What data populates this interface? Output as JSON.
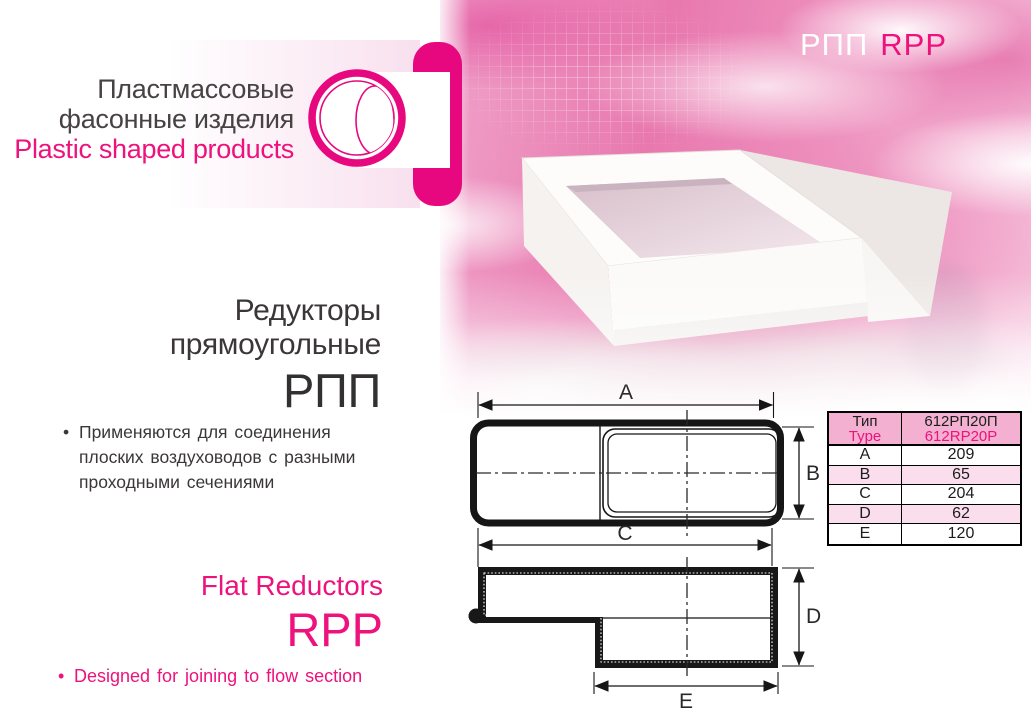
{
  "brand": {
    "title_ru_line1": "Пластмассовые",
    "title_ru_line2": "фасонные изделия",
    "title_en": "Plastic shaped products"
  },
  "hero": {
    "code_ru": "РПП",
    "code_en": "RPP"
  },
  "product": {
    "heading_ru_line1": "Редукторы",
    "heading_ru_line2": "прямоугольные",
    "code_ru": "РПП",
    "heading_en": "Flat Reductors",
    "code_en": "RPP",
    "bullet_ru": "Применяются для соединения плоских воздуховодов с разными проходными сечениями",
    "bullet_en": "Designed for joining to flow section",
    "bullet_char": "•"
  },
  "drawings": {
    "labels": {
      "a": "A",
      "b": "B",
      "c": "C",
      "d": "D",
      "e": "E"
    }
  },
  "spec_table": {
    "header_param_ru": "Тип",
    "header_param_en": "Type",
    "header_value_ru": "612РП20П",
    "header_value_en": "612RP20P",
    "rows": [
      {
        "param": "A",
        "value": "209"
      },
      {
        "param": "B",
        "value": "65"
      },
      {
        "param": "C",
        "value": "204"
      },
      {
        "param": "D",
        "value": "62"
      },
      {
        "param": "E",
        "value": "120"
      }
    ]
  },
  "colors": {
    "brand_magenta": "#e7077e",
    "text_magenta": "#ed127c",
    "dark_text": "#3b3738",
    "table_header_bg": "#f3b0d0",
    "table_alt_row_bg": "#fbdeee",
    "drawing_line": "#161616"
  }
}
